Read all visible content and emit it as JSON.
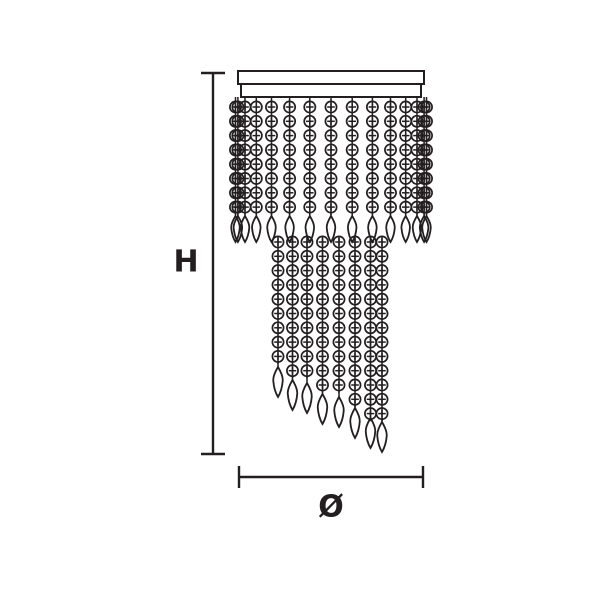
{
  "diagram": {
    "description": "dimension drawing of a two-tier crystal bead pendant ceiling light",
    "background": "#ffffff",
    "ink": "#231f20",
    "height_label": "H",
    "diameter_label": "Ø",
    "h_dimension": {
      "line_x": 213,
      "top_y": 72,
      "bottom_y": 455,
      "tick_half": 12,
      "label_x": 186,
      "label_y": 262
    },
    "dia_dimension": {
      "line_y": 477,
      "left_x": 238,
      "right_x": 423,
      "tick_half": 11,
      "label_x": 331,
      "label_y": 507
    },
    "canopy": {
      "outer": {
        "x": 238,
        "y": 71,
        "w": 186,
        "h": 13
      },
      "inner": {
        "x": 241,
        "y": 84,
        "w": 180,
        "h": 13
      }
    },
    "bead": {
      "radius": 5.6,
      "pitch": 14.3,
      "cross_half": 3.8
    },
    "outer_tier": {
      "hang_y": 97,
      "first_bead_y": 107,
      "rows": 8,
      "strand_x": [
        235.5,
        237.9,
        245.0,
        256.3,
        271.5,
        289.6,
        309.8,
        331,
        352.2,
        372.4,
        390.5,
        405.7,
        417.0,
        424.1,
        426.5
      ],
      "drop_tip_y": 242,
      "drop_w": 9,
      "drop_h": 26
    },
    "inner_tier": {
      "first_bead_y": 242,
      "strand_x": [
        278,
        292.5,
        307,
        322.5,
        339,
        355,
        370.5,
        382
      ],
      "drop_tip_y": [
        397,
        410,
        413,
        424,
        427,
        438,
        448,
        452
      ],
      "drop_w": 10,
      "drop_h": 30
    },
    "stroke": {
      "dimension": 2.4,
      "canopy": 2,
      "chain": 1.5,
      "bead": 1.7,
      "cross": 1.5,
      "drop": 1.8
    }
  }
}
